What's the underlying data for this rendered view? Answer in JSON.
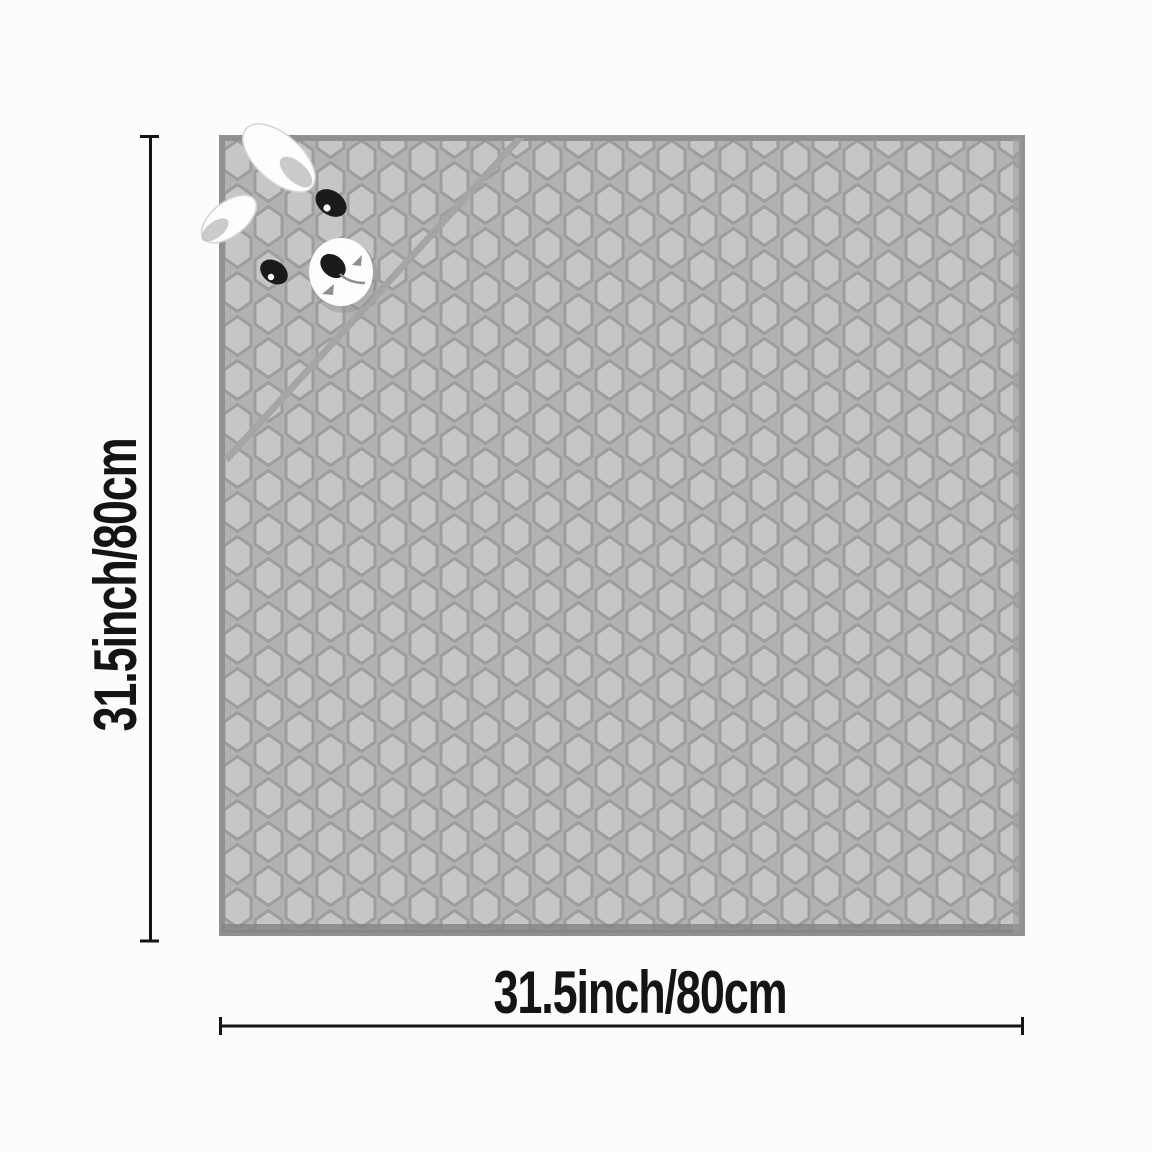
{
  "image": {
    "description": "Gray honeycomb-textured pet mat with a cartoon puppy face peeking from the folded top-left corner, annotated with product dimensions",
    "background": "#fcfcfb"
  },
  "dimensions": {
    "height_label": "31.5inch/80cm",
    "width_label": "31.5inch/80cm"
  },
  "colors": {
    "mat_base": "#b2b2b2",
    "cell_fill": "#c6c6c6",
    "cell_outline": "#9d9d9d",
    "mat_border": "#909090",
    "mat_edge_shadow": "#868686",
    "mat_right_edge": "#9a9a9a",
    "seam": "#a5a5a5",
    "face_white": "#fdfdfd",
    "face_black": "#1b1b1b",
    "face_gray": "#8f8f8f",
    "face_shade": "#c2c2c2",
    "annotation": "#141414"
  }
}
